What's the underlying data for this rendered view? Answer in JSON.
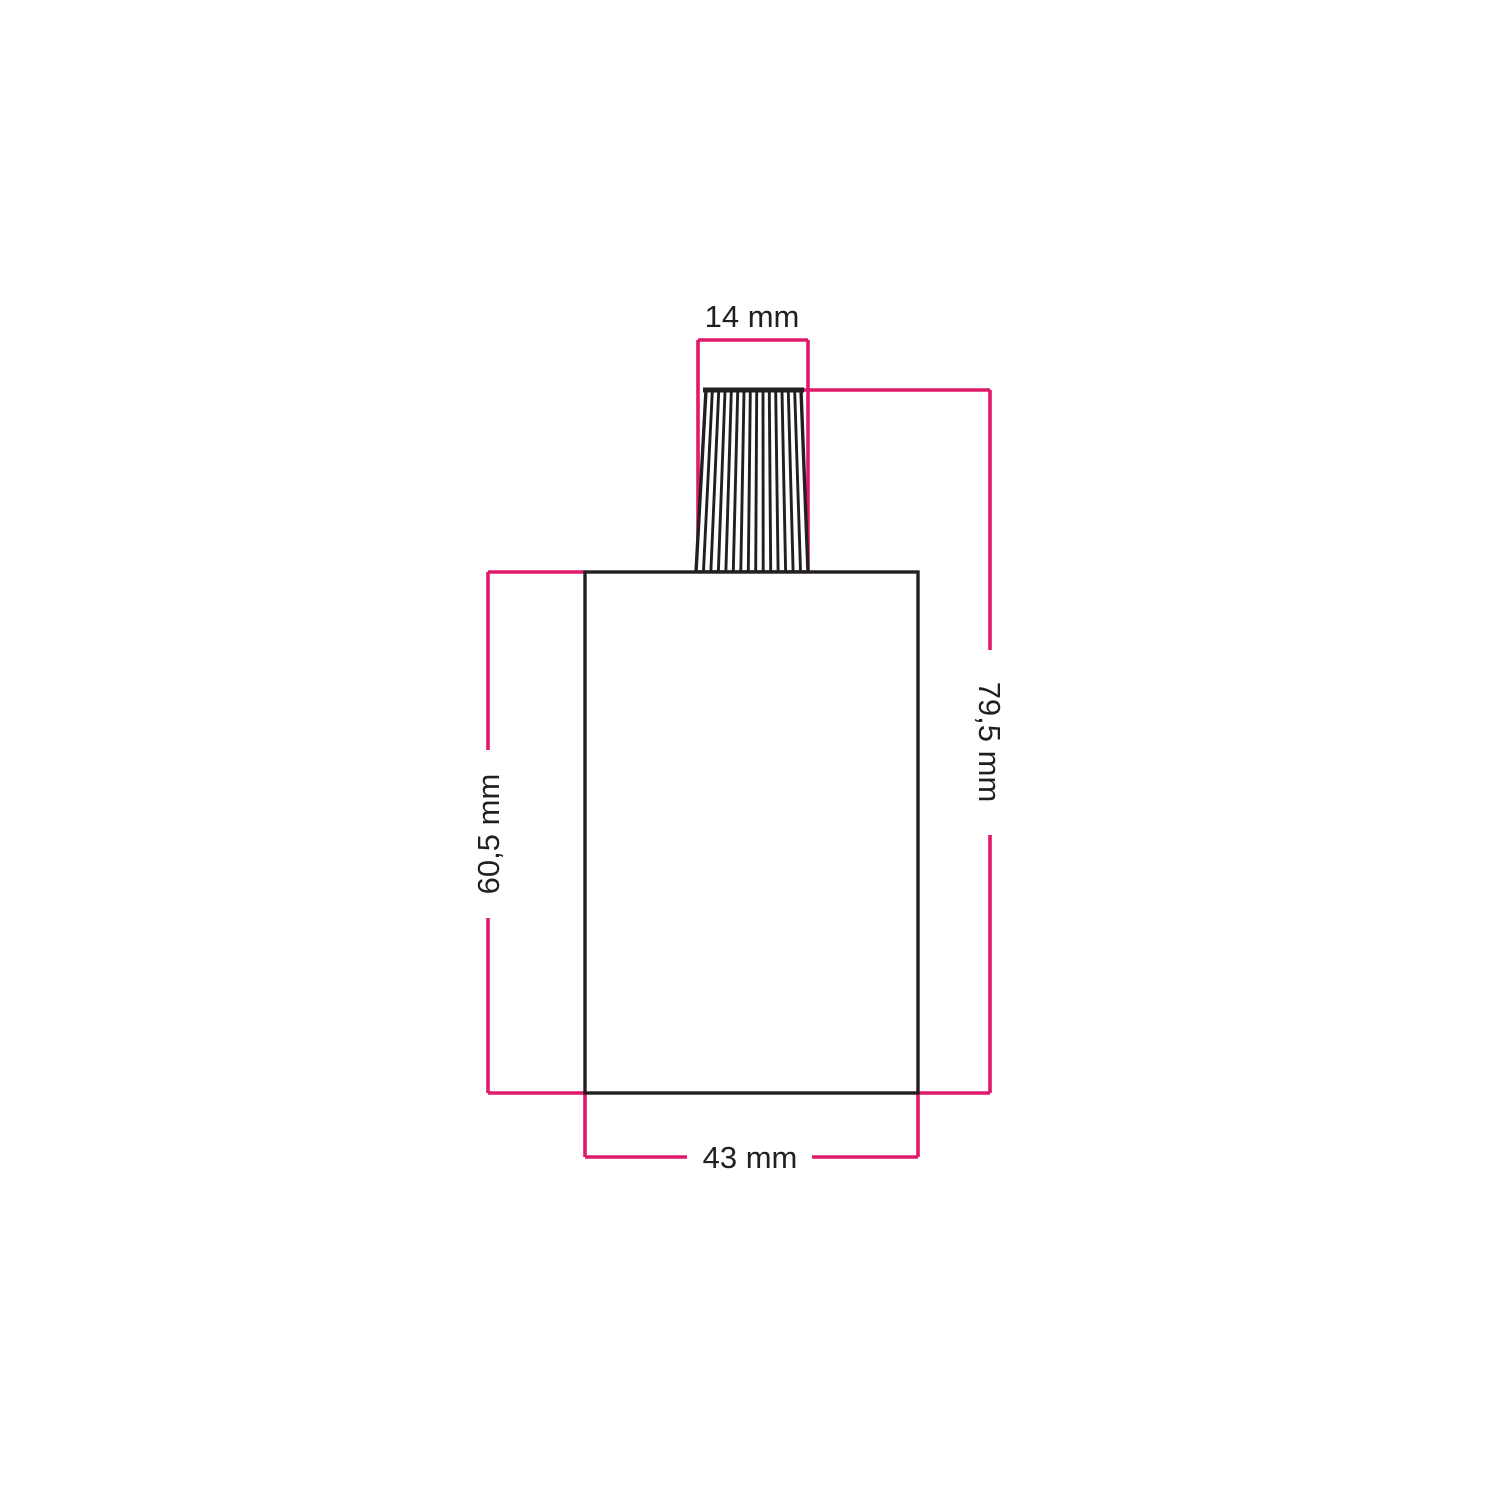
{
  "drawing": {
    "labels": {
      "cable_grip_width": "14 mm",
      "total_height": "79,5 mm",
      "body_height": "60,5 mm",
      "body_width": "43 mm"
    },
    "colors": {
      "dimension_line": "#e0196b",
      "outline": "#231f20",
      "background": "#ffffff"
    }
  }
}
